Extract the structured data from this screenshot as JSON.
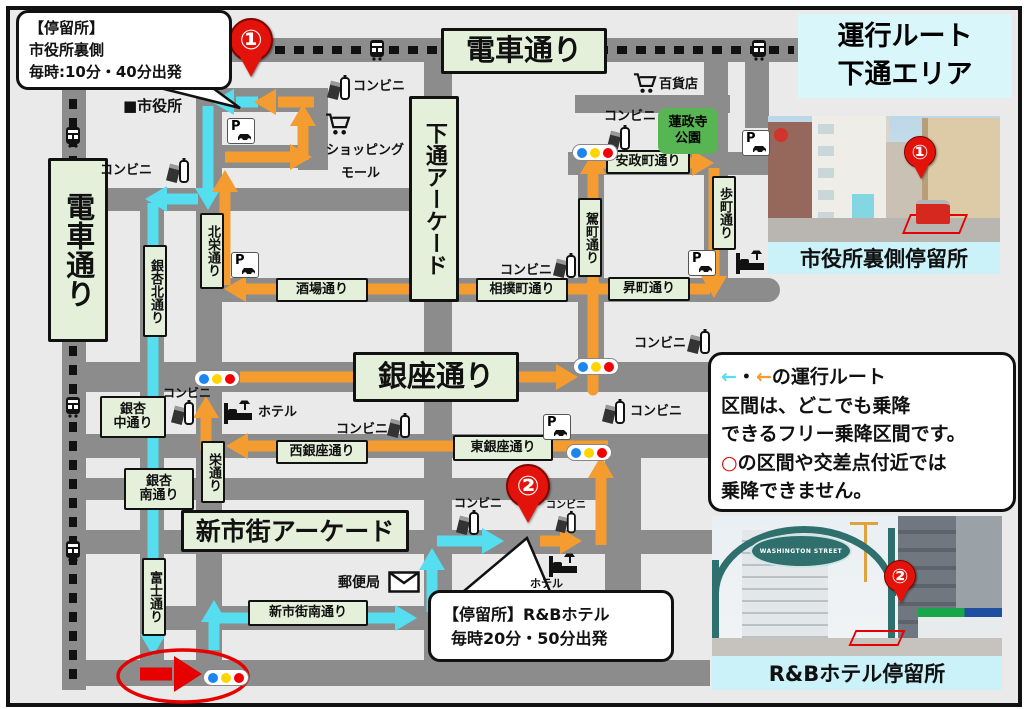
{
  "title": {
    "line1": "運行ルート",
    "line2": "下通エリア"
  },
  "callout1": {
    "line1": "【停留所】",
    "line2": "市役所裏側",
    "line3": "毎時:10分・40分出発"
  },
  "callout2": {
    "line1": "【停留所】R&Bホテル",
    "line2": "毎時20分・50分出発"
  },
  "notice": {
    "arrow_cyan": "←",
    "dot": "・",
    "arrow_orange": "←",
    "line1_rest": "の運行ルート",
    "line2": "区間は、どこでも乗降",
    "line3": "できるフリー乗降区間です。",
    "circle": "○",
    "line4_rest": "の区間や交差点付近では",
    "line5": "乗降できません。"
  },
  "streets": {
    "densha": "電車通り",
    "shimotori": "下通アーケード",
    "hokuei": "北栄通り",
    "icho_kita": "銀杏北通り",
    "icho_naka1": "銀杏",
    "icho_naka2": "中通り",
    "icho_minami1": "銀杏",
    "icho_minami2": "南通り",
    "fuji": "富士通り",
    "sakae": "栄通り",
    "kago": "駕町通り",
    "aruki": "歩町通り",
    "ansei": "安政町通り",
    "nobori": "昇町通り",
    "sumo": "相撲町通り",
    "sakaba": "酒場通り",
    "ginza": "銀座通り",
    "nishi_ginza": "西銀座通り",
    "higashi_ginza": "東銀座通り",
    "shinshigai": "新市街アーケード",
    "shinshigai_minami": "新市街南通り"
  },
  "pois": {
    "cityhall": "■市役所",
    "conbini": "コンビニ",
    "dept": "百貨店",
    "mall1": "ショッピング",
    "mall2": "モール",
    "park1": "蓮政寺",
    "park2": "公園",
    "hotel": "ホテル",
    "post": "郵便局",
    "parking": "P"
  },
  "pins": {
    "one": "①",
    "two": "②"
  },
  "captions": {
    "photo1": "市役所裏側停留所",
    "photo2": "R&Bホテル停留所",
    "arch_sign": "WASHINGTON STREET"
  },
  "colors": {
    "route_orange": "#F49C2F",
    "route_cyan": "#55DEEF",
    "alert_red": "#E60000",
    "street_gray": "#8C8C8C",
    "label_green_bg": "#E4F0DA",
    "park_green": "#58B554",
    "title_cyan": "#D9F6FB",
    "caption_cyan": "#CBF2F8",
    "pin_red": "#E3120B",
    "signal_blue": "#1C86EE",
    "signal_yellow": "#FFD400",
    "signal_red": "#F40000"
  },
  "icons": {
    "tram": "tram-front glyph on dashed track",
    "convenience": "carton+bottle glyph",
    "cart": "shopping-cart glyph",
    "parking": "P with car glyph",
    "hotel": "bed with lamp glyph",
    "post": "envelope glyph",
    "traffic_light": "blue/yellow/red dots pill",
    "pin": "red numbered map pin",
    "cityhall": "black square"
  }
}
